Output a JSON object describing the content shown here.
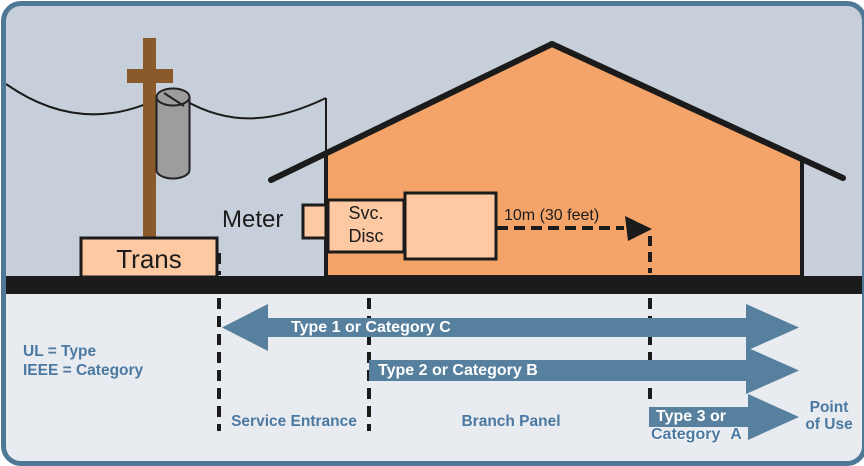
{
  "diagram": {
    "labels": {
      "meter": "Meter",
      "trans": "Trans",
      "svc_disc_line1": "Svc.",
      "svc_disc_line2": "Disc",
      "distance": "10m (30 feet)"
    },
    "legend": {
      "line1": "UL = Type",
      "line2": "IEEE = Category"
    },
    "zones": {
      "service_entrance": "Service Entrance",
      "branch_panel": "Branch Panel",
      "point_of_use_line1": "Point",
      "point_of_use_line2": "of Use"
    },
    "arrows": [
      {
        "label": "Type 1 or Category C"
      },
      {
        "label": "Type 2 or Category B"
      },
      {
        "label": "Type 3 or",
        "sublabel": "Category A"
      }
    ],
    "colors": {
      "border": "#4f7896",
      "background_top": "#c7cfda",
      "background_bottom": "#e8ebf0",
      "ground": "#1b1b1b",
      "house": "#f4a469",
      "equipment_box": "#fcc9a2",
      "pole": "#8a5a2b",
      "transformer": "#9d9d9d",
      "arrow": "#56809e",
      "label_text": "#4b79a1",
      "arrow_text": "#ffffff"
    }
  }
}
